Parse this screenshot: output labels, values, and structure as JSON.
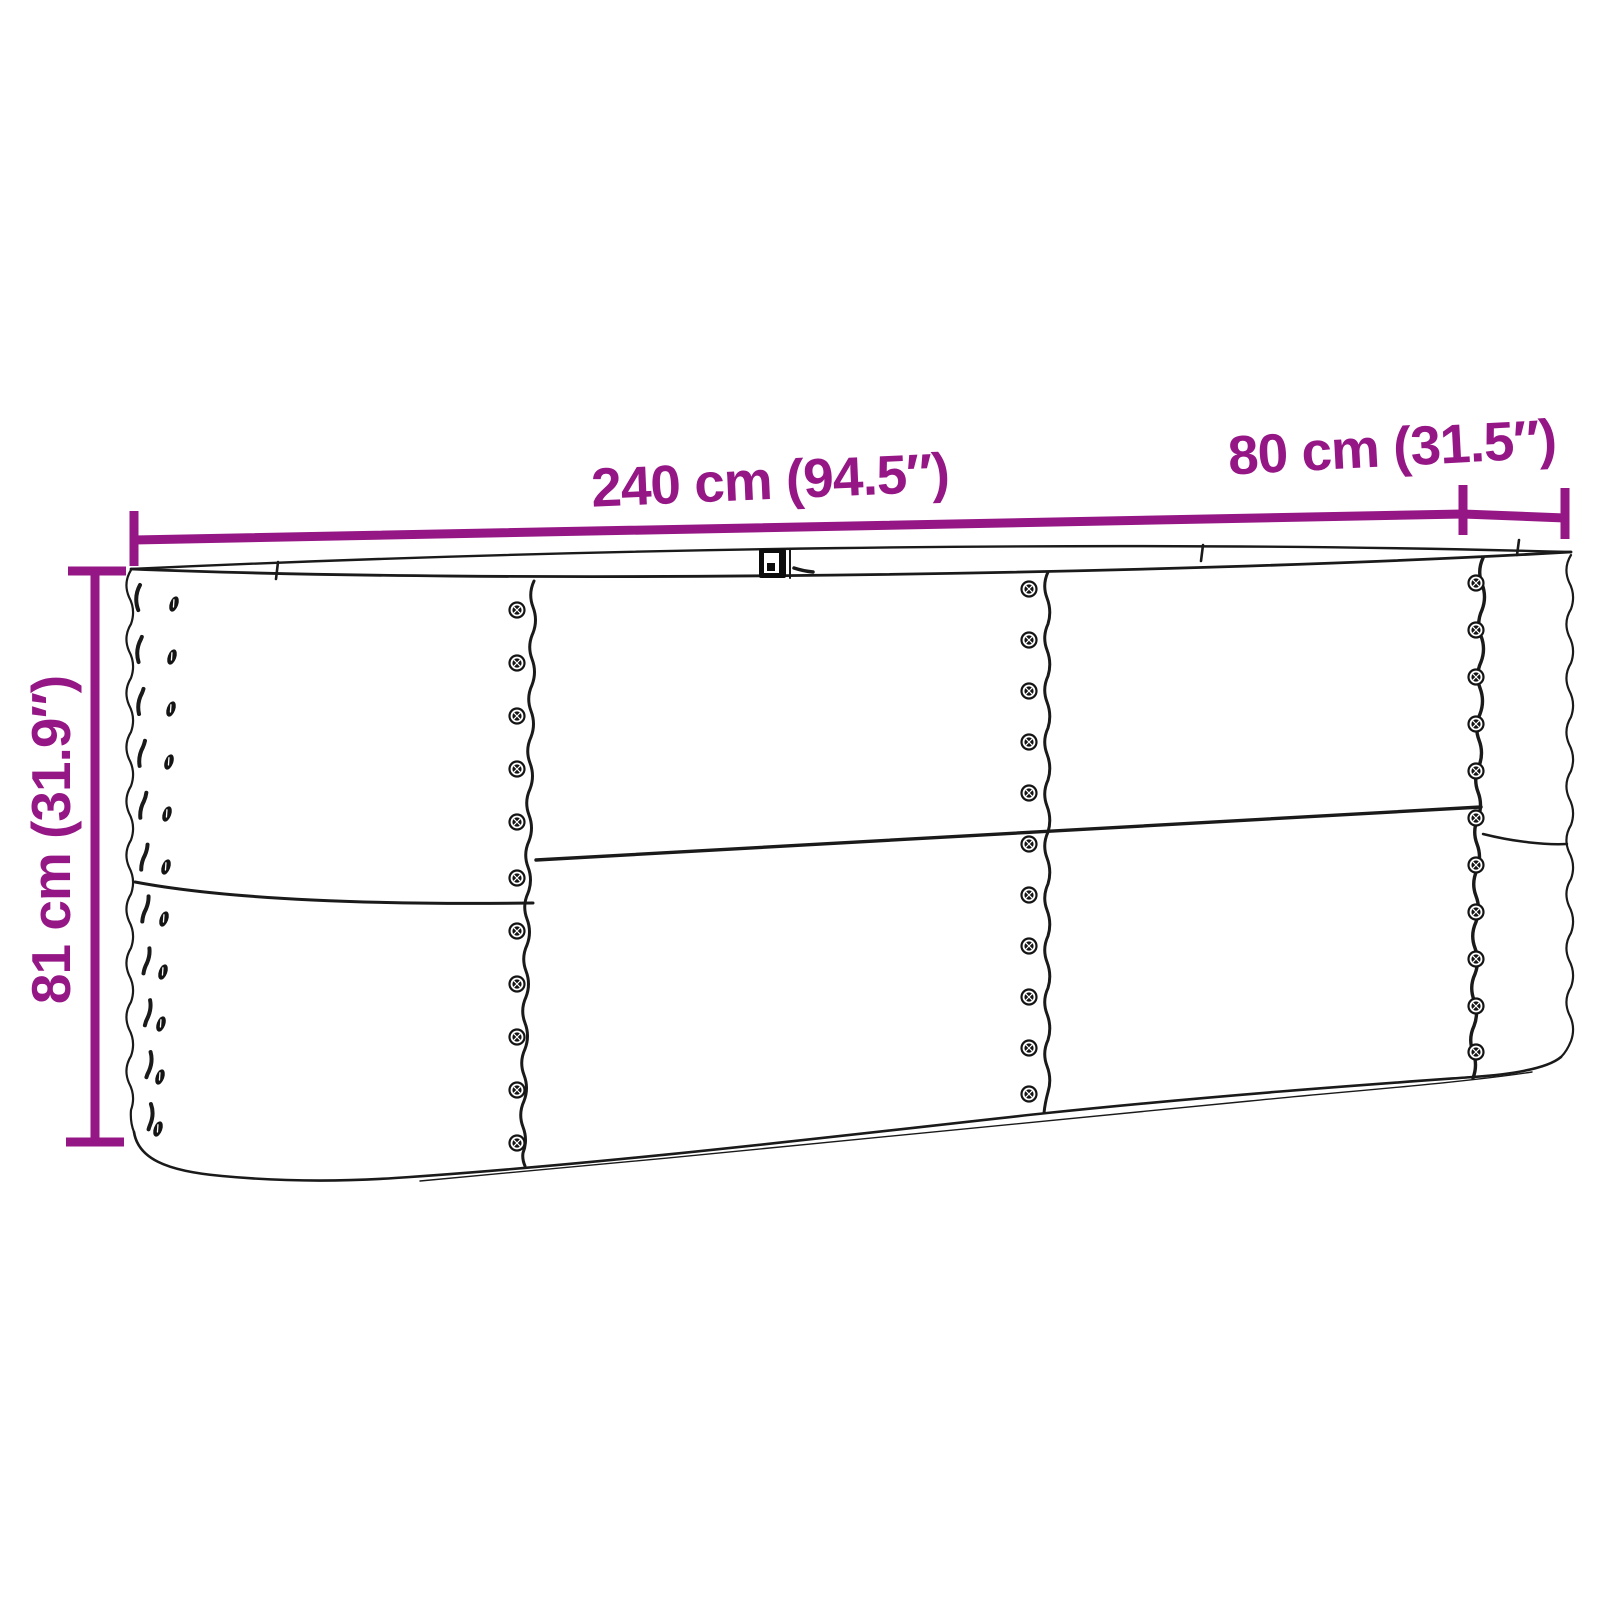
{
  "diagram": {
    "alt": "Line drawing of an oval corrugated metal raised garden bed with dimension arrows",
    "background": "#ffffff",
    "line_color": "#1a1a1a",
    "accent_color": "#951685",
    "labels": {
      "length": "240 cm (94.5″)",
      "depth": "80 cm (31.5″)",
      "height": "81 cm (31.9″)"
    }
  }
}
